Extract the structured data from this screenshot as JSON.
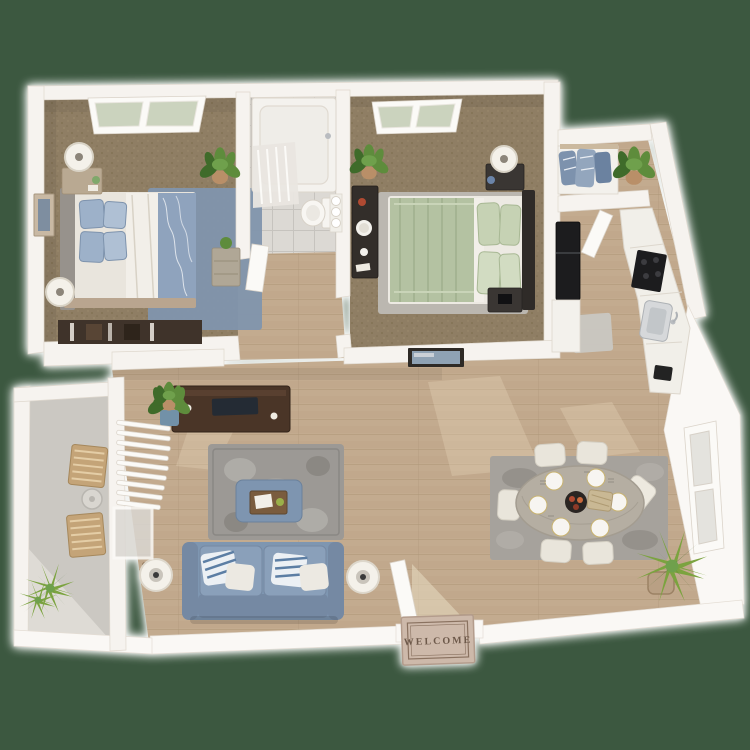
{
  "scene": {
    "description": "3D top-down floor plan render of a one-level two-bedroom apartment",
    "background_color": "#3C5840",
    "mat_text": "WELCOME"
  },
  "colors": {
    "background": "#3C5840",
    "wall": "#F6F3EF",
    "wood_floor": "#C3AB8F",
    "wood_line": "#AE9678",
    "carpet": "#8F7E64",
    "carpet_dot": "#786849",
    "tile": "#DCD9D4",
    "patio_floor": "#CBC8C2",
    "patio_light": "#DEDBD5",
    "rug_living": "#9C9995",
    "rug_living_motif": "#B3B0AB",
    "rug_dining": "#A6A29C",
    "rug_bed1": "#8195AD",
    "rug_bed2": "#BBB7B0",
    "sofa": "#7E96B1",
    "sofa_cushion": "#8AA0BA",
    "sofa_dark": "#7589A3",
    "ottoman": "#7E95B0",
    "tray": "#7A5C3E",
    "pillow_white": "#ECE9E2",
    "pillow_stripe": "#5C7EA4",
    "bed1_blanket": "#8FA3BD",
    "bed1_pillow": "#9DB1C9",
    "duvet": "#F2EFE9",
    "headboard1": "#97928C",
    "bed2_blanket": "#B4C2A2",
    "bed2_pillow": "#C6D2B4",
    "headboard2": "#2F2B28",
    "dark_wood": "#4A3527",
    "black_appliance": "#1C1C1E",
    "dining_table": "#B5AEA2",
    "chair": "#E9E5DB",
    "wood_chair": "#C4A478",
    "plant": "#5E8C3C",
    "plant_dark": "#3F6B2A",
    "plant_spiky": "#7BA33F",
    "pot": "#B98F68",
    "pot_blue": "#7291A8",
    "mat": "#CDB9AA",
    "mat_border": "#8A7260",
    "mat_text_color": "#6D594A",
    "glass_green": "#CBD3BE",
    "lamp_shade": "#F4F1EA"
  }
}
